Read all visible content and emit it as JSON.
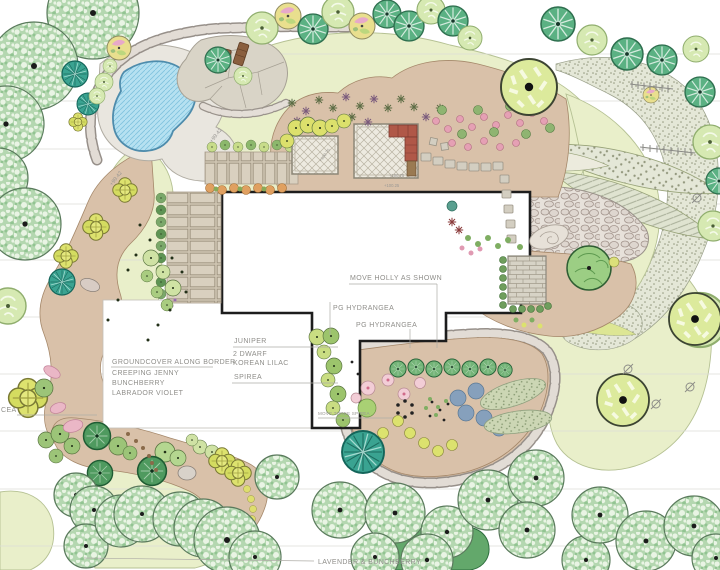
{
  "plan": {
    "annotations": {
      "move_holly": "MOVE HOLLY AS SHOWN",
      "pg_hydrangea_upper": "PG HYDRANGEA",
      "pg_hydrangea_lower": "PG HYDRANGEA",
      "juniper": "JUNIPER",
      "dwarf_korean_lilac_line1": "2 DWARF",
      "dwarf_korean_lilac_line2": "KOREAN LILAC",
      "spirea": "SPIREA",
      "groundcover": "GROUNDCOVER ALONG BORDER",
      "creeping_jenny": "CREEPING JENNY",
      "bunchberry": "BUNCHBERRY",
      "labrador_violet": "LABRADOR VIOLET",
      "move_three_spirea": "MOVE THREE SPIREA",
      "lavender_bunchberry": "LAVENDER & BUNCHBERRY",
      "cea_partial": "CEA"
    },
    "elevations": {
      "e1": "+99.42",
      "e2": "+99.42",
      "e3": "+100.75",
      "e4": "+100.75",
      "e5": "+100.25"
    },
    "colors": {
      "lawn": "#e9efca",
      "planting_bed": "#d9c1a9",
      "pool_water": "#b6e1f1",
      "boulder": "#e2dcd5",
      "house_wall": "#1d1d1d",
      "label_text": "#8f8e8a",
      "sofa": "#b05848",
      "lounge_chair": "#8a5f3e"
    }
  }
}
